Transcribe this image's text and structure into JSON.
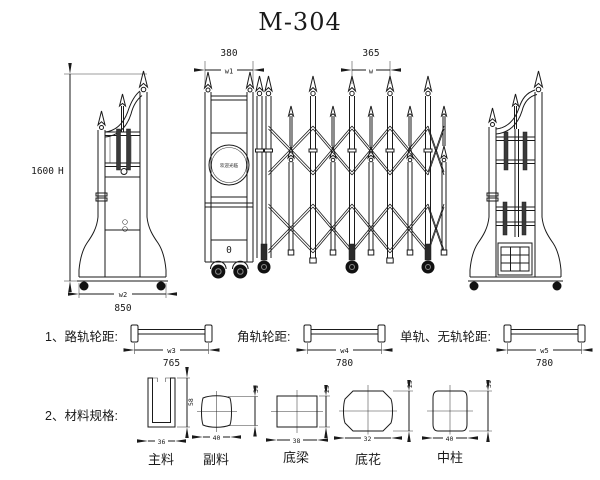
{
  "title": "M-304",
  "colors": {
    "line": "#1a1a1a",
    "background": "#ffffff"
  },
  "elevation": {
    "height_value": "1600",
    "height_label": "H",
    "base_width_label": "w2",
    "base_width_value": "850",
    "head_width_value": "380",
    "head_width_label": "w1",
    "pitch_value": "365",
    "pitch_label": "w",
    "sign_text": "欢迎光临",
    "zero_label": "0"
  },
  "track_section": {
    "items": [
      {
        "label": "1、路轨轮距:",
        "dim_label": "w3",
        "dim_value": "765"
      },
      {
        "label": "角轨轮距:",
        "dim_label": "w4",
        "dim_value": "780"
      },
      {
        "label": "单轨、无轨轮距:",
        "dim_label": "w5",
        "dim_value": "780"
      }
    ]
  },
  "material_section": {
    "label": "2、材料规格:",
    "profiles": [
      {
        "name": "主料",
        "width": "36",
        "height": "58"
      },
      {
        "name": "副料",
        "width": "40",
        "height": "31"
      },
      {
        "name": "底梁",
        "width": "38",
        "height": "25"
      },
      {
        "name": "底花",
        "width": "32",
        "height": "25"
      },
      {
        "name": "中柱",
        "width": "40",
        "height": "31"
      }
    ]
  }
}
